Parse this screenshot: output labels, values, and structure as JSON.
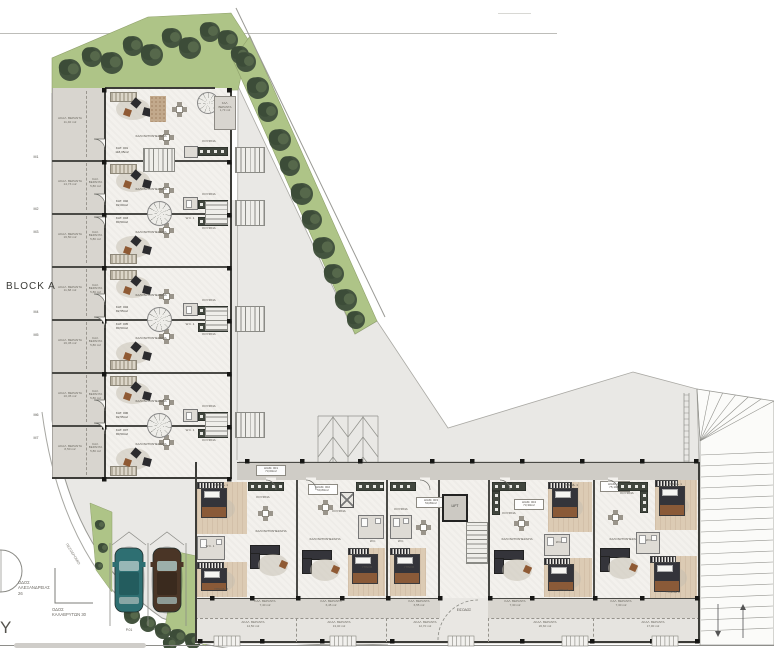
{
  "legend": {
    "block_a": "BLOCK A",
    "cropped_word": "Y",
    "sidewalk": "ΠΕΖΟΔΡΟΜΙΟ",
    "street_1": "ΟΔΟΣ\nΑΛΕΞΑΝΔΡΕΙΑΣ 26",
    "street_2": "ΟΔΟΣ\nΚΑΛΑΒΡΥΤΩΝ 30",
    "parking": [
      "P.01",
      "P.02"
    ]
  },
  "block_a": {
    "room_labels": {
      "living": "ΣΑΛΟΝΙ/ΤΡΑΠΕΖΑΡΙΑ",
      "kitchen": "ΚΟΥΖΙΝΑ",
      "wc": "W.C. 1"
    },
    "veranda_labels": {
      "akal": "ΑΚΑΛ. ΒΕΡΑΝΤΑ",
      "kal": "ΚΑΛ. ΒΕΡΑΝΤΑ"
    },
    "units": [
      {
        "id": "ΚΑΤ. 001",
        "area": "118,35m2",
        "akal_area": "11,40 m2",
        "kal_area": "1,73 m2"
      },
      {
        "id": "ΚΑΤ. 002",
        "area": "82,00m2",
        "akal_area": "14,73 m2",
        "kal_area": "5,80 m2"
      },
      {
        "id": "ΚΑΤ. 003",
        "area": "80,50m2",
        "akal_area": "16,50 m2",
        "kal_area": "5,80 m2"
      },
      {
        "id": "ΚΑΤ. 004",
        "area": "82,55m2",
        "akal_area": "11,68 m2",
        "kal_area": "5,80 m2"
      },
      {
        "id": "ΚΑΤ. 005",
        "area": "80,50m2",
        "akal_area": "16,45 m2",
        "kal_area": "5,80 m2"
      },
      {
        "id": "ΚΑΤ. 006",
        "area": "82,55m2",
        "akal_area": "10,45 m2",
        "kal_area": "5,80 m2"
      },
      {
        "id": "ΚΑΤ. 007",
        "area": "80,50m2",
        "akal_area": "8,50 m2",
        "kal_area": "5,80 m2"
      }
    ],
    "doors": [
      "M1",
      "M2",
      "M3",
      "M4",
      "M5",
      "M6",
      "M7"
    ]
  },
  "wing": {
    "lift": "LIFT",
    "entrance": "ΕΙΣΟΔΟΣ",
    "room_labels": {
      "living": "ΣΑΛΟΝΙ/ΤΡΑΠΕΖΑΡΙΑ",
      "kitchen": "ΚΟΥΖΙΝΑ",
      "bed1": "ΥΠΝΟΔ. 1",
      "bed2": "ΥΠΝΟΔ. 2",
      "bed": "ΥΠΝΟΣ",
      "wc": "W.C.",
      "wc1": "W.C. 1",
      "kal": "ΚΑΛ. ΒΕΡΑΝΤΑ",
      "akal": "ΑΚΑΛ. ΒΕΡΑΝΤΑ"
    },
    "apartments": [
      {
        "id": "ΔΙΑΜ. 001",
        "area": "73,00m2",
        "kal_area": "7,40 m2",
        "akal_area": "14,50 m2"
      },
      {
        "id": "ΔΙΑΜ. 002",
        "area": "50,80m2",
        "kal_area": "6,45 m2",
        "akal_area": "13,40 m2"
      },
      {
        "id": "ΔΙΑΜ. 003",
        "area": "50,80m2",
        "kal_area": "6,55 m2",
        "akal_area": "12,70 m2"
      },
      {
        "id": "ΔΙΑΜ. 004",
        "area": "73,30m2",
        "kal_area": "7,30 m2",
        "akal_area": "20,60 m2"
      },
      {
        "id": "ΔΙΑΜ. 005",
        "area": "75,10m2",
        "kal_area": "7,30 m2",
        "akal_area": "17,00 m2"
      }
    ]
  },
  "colors": {
    "ground": "#e9e8e5",
    "green": "#aec487",
    "tree_dark": "#3c4c38",
    "tree_mid": "#44543f",
    "tree_light": "#56684b",
    "floor": "#f3f1ed",
    "veranda": "#d8d5cf",
    "corridor": "#cfccc6",
    "wood": "#dccbb4",
    "kitchen_dark": "#41463e",
    "wall": "#3c3c38",
    "car_teal": "#2e6f72",
    "car_brown": "#4a3526"
  }
}
